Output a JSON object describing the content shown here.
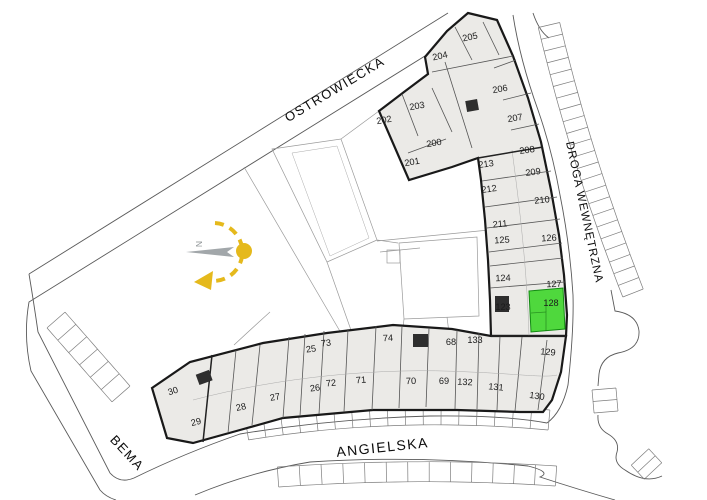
{
  "title": "Site plan with apartment unit numbers",
  "colors": {
    "highlight": "#4fd83d",
    "building_fill": "#ebeae7",
    "outline": "#191919",
    "accent_yellow": "#e5b91c",
    "arrow_gray": "#a2a7aa",
    "label": "#1b1b1b"
  },
  "highlighted_unit": "128",
  "compass": {
    "north_label": "N"
  },
  "streets": [
    {
      "name": "OSTROWIECKA",
      "x": 337,
      "y": 93,
      "rotate": -31,
      "size": 13,
      "ls": 1.5
    },
    {
      "name": "DROGA WEWNĘTRZNA",
      "x": 581,
      "y": 213,
      "rotate": 78,
      "size": 11.5,
      "ls": 1
    },
    {
      "name": "ANGIELSKA",
      "x": 383,
      "y": 452,
      "rotate": -6,
      "size": 14,
      "ls": 1.5
    },
    {
      "name": "BEMA",
      "x": 124,
      "y": 456,
      "rotate": 47,
      "size": 13,
      "ls": 1.5
    }
  ],
  "units": [
    {
      "n": "202",
      "x": 384,
      "y": 120,
      "r": -10
    },
    {
      "n": "203",
      "x": 417,
      "y": 106,
      "r": -10
    },
    {
      "n": "204",
      "x": 440,
      "y": 56,
      "r": -12
    },
    {
      "n": "205",
      "x": 470,
      "y": 37,
      "r": -12
    },
    {
      "n": "206",
      "x": 500,
      "y": 89,
      "r": -10
    },
    {
      "n": "207",
      "x": 515,
      "y": 118,
      "r": -10
    },
    {
      "n": "200",
      "x": 434,
      "y": 143,
      "r": -10
    },
    {
      "n": "201",
      "x": 412,
      "y": 162,
      "r": -10
    },
    {
      "n": "208",
      "x": 527,
      "y": 150,
      "r": -8
    },
    {
      "n": "213",
      "x": 486,
      "y": 164,
      "r": -8
    },
    {
      "n": "209",
      "x": 533,
      "y": 172,
      "r": -8
    },
    {
      "n": "212",
      "x": 489,
      "y": 189,
      "r": -8
    },
    {
      "n": "210",
      "x": 542,
      "y": 200,
      "r": -6
    },
    {
      "n": "211",
      "x": 500,
      "y": 224,
      "r": -5
    },
    {
      "n": "125",
      "x": 502,
      "y": 240,
      "r": -4
    },
    {
      "n": "126",
      "x": 549,
      "y": 238,
      "r": -4
    },
    {
      "n": "124",
      "x": 503,
      "y": 278,
      "r": -2
    },
    {
      "n": "127",
      "x": 554,
      "y": 284,
      "r": -2
    },
    {
      "n": "123",
      "x": 503,
      "y": 307,
      "r": 0
    },
    {
      "n": "128",
      "x": 551,
      "y": 303,
      "r": 0,
      "hl": true
    },
    {
      "n": "133",
      "x": 475,
      "y": 340,
      "r": 0
    },
    {
      "n": "129",
      "x": 548,
      "y": 352,
      "r": 5
    },
    {
      "n": "132",
      "x": 465,
      "y": 382,
      "r": 3
    },
    {
      "n": "131",
      "x": 496,
      "y": 387,
      "r": 5
    },
    {
      "n": "130",
      "x": 537,
      "y": 396,
      "r": 8
    },
    {
      "n": "68",
      "x": 451,
      "y": 342,
      "r": 0
    },
    {
      "n": "69",
      "x": 444,
      "y": 381,
      "r": 0
    },
    {
      "n": "74",
      "x": 388,
      "y": 338,
      "r": -3
    },
    {
      "n": "70",
      "x": 411,
      "y": 381,
      "r": -2
    },
    {
      "n": "71",
      "x": 361,
      "y": 380,
      "r": -5
    },
    {
      "n": "72",
      "x": 331,
      "y": 383,
      "r": -6
    },
    {
      "n": "73",
      "x": 326,
      "y": 343,
      "r": -6
    },
    {
      "n": "25",
      "x": 311,
      "y": 349,
      "r": -8
    },
    {
      "n": "26",
      "x": 315,
      "y": 388,
      "r": -8
    },
    {
      "n": "27",
      "x": 275,
      "y": 397,
      "r": -10
    },
    {
      "n": "28",
      "x": 241,
      "y": 407,
      "r": -12
    },
    {
      "n": "29",
      "x": 196,
      "y": 422,
      "r": -14
    },
    {
      "n": "30",
      "x": 173,
      "y": 391,
      "r": -18
    }
  ]
}
